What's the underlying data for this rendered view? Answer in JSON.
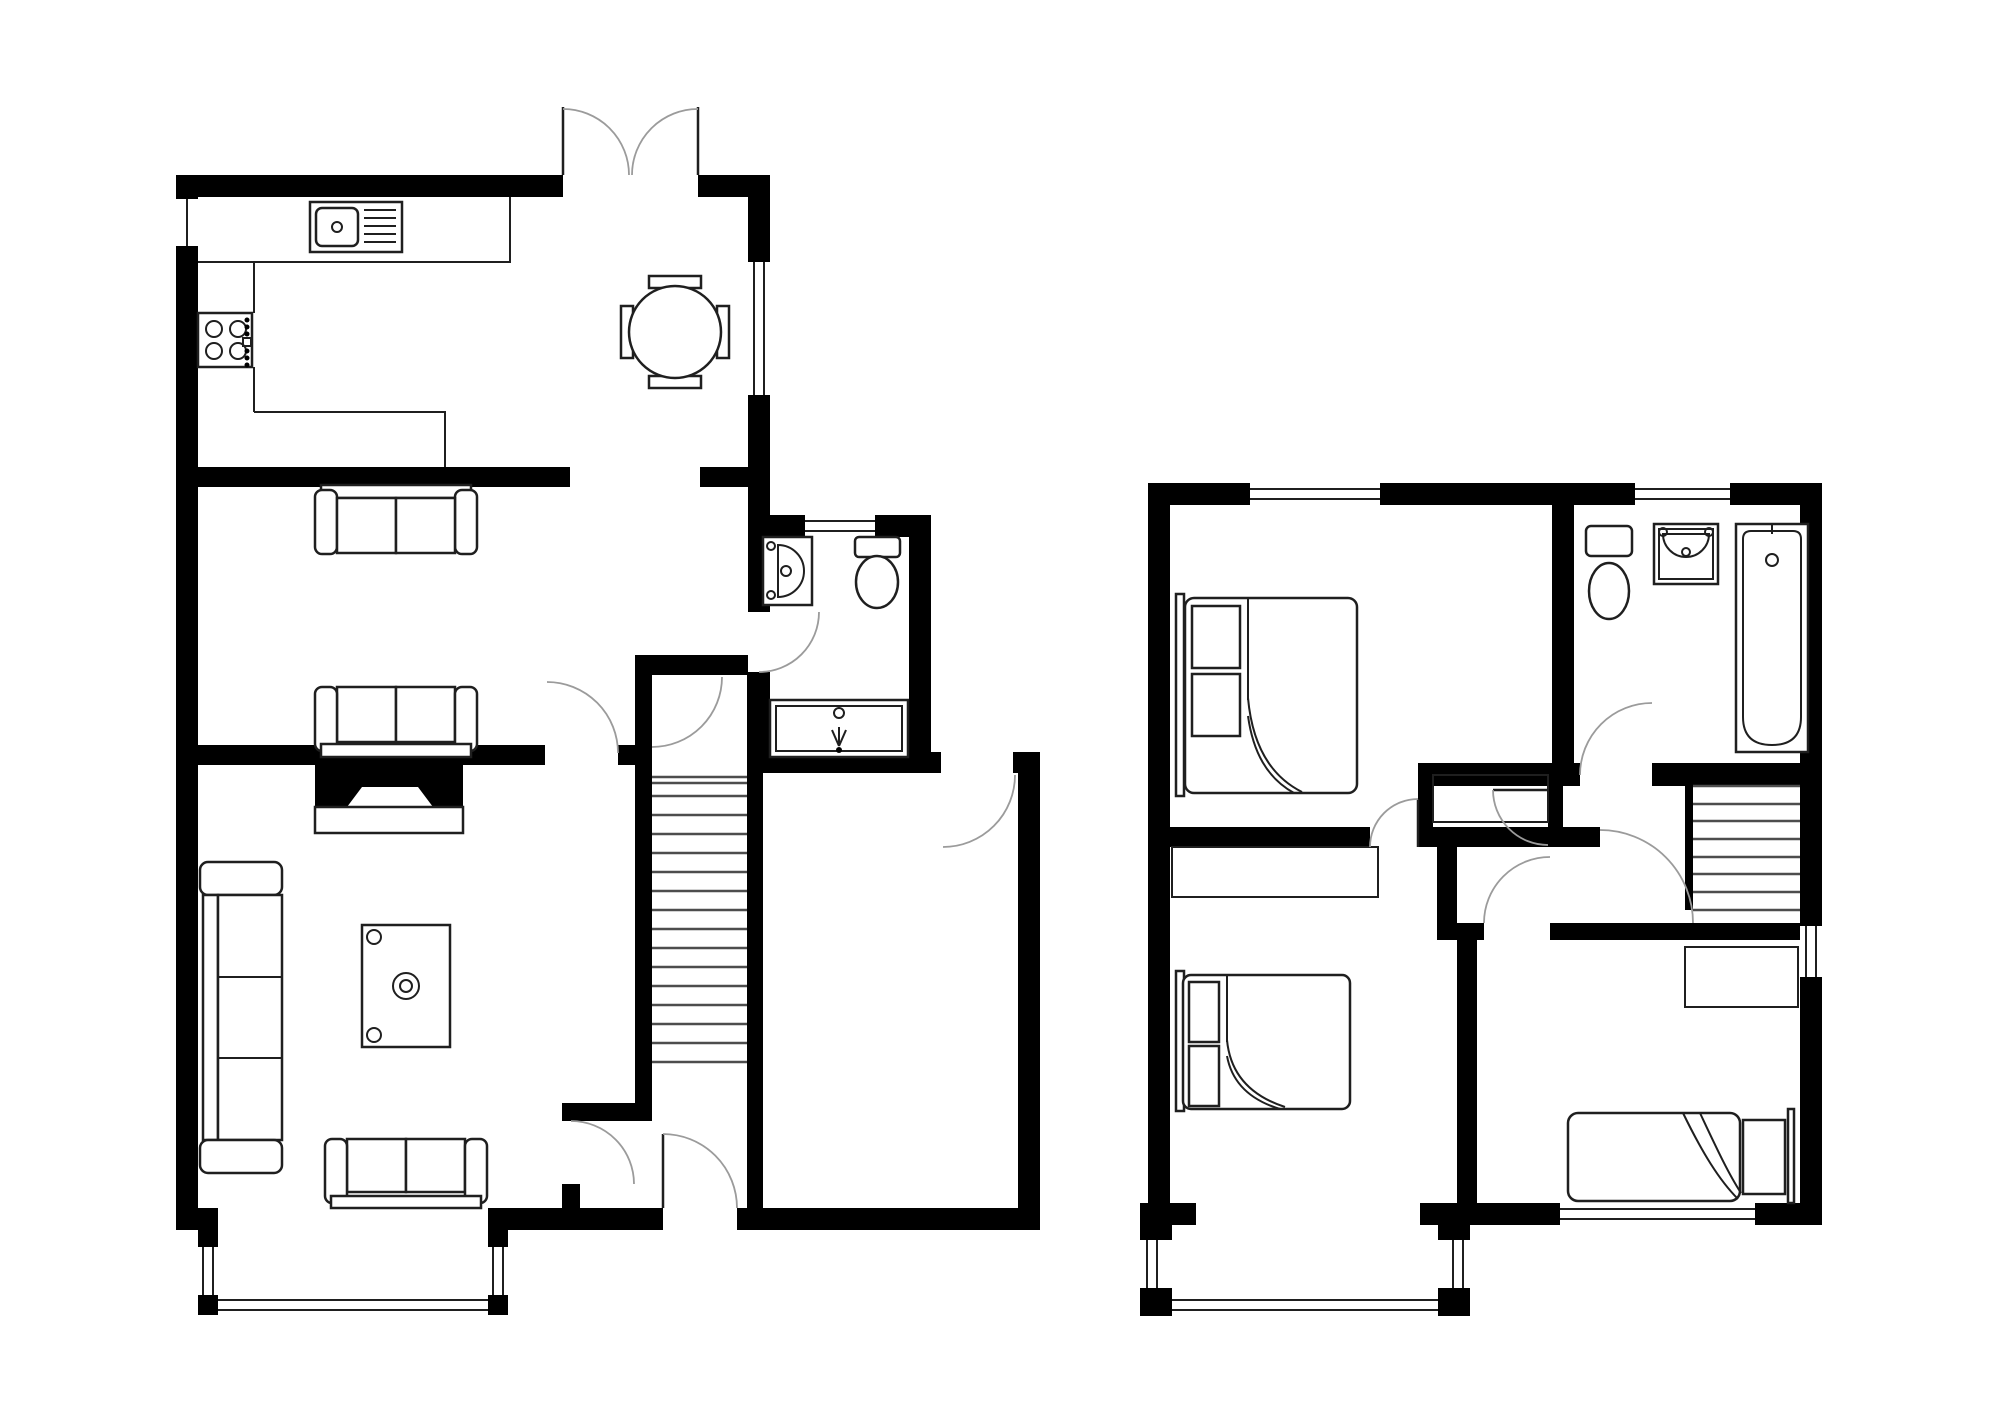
{
  "drawing": {
    "kind": "floor-plan",
    "visible_text": [],
    "floors": [
      {
        "id": "ground-floor",
        "position": "left",
        "rooms": [
          {
            "name": "kitchen-dining",
            "features": [
              "sink-with-drainer",
              "hob-4-burners",
              "l-shaped-worktop",
              "round-dining-table",
              "four-chairs",
              "double-french-doors",
              "side-window",
              "small-window"
            ]
          },
          {
            "name": "sitting-room",
            "features": [
              "two-seat-sofa",
              "two-seat-sofa",
              "fireplace-with-hearth",
              "door"
            ]
          },
          {
            "name": "living-room",
            "features": [
              "three-seat-corner-sofa",
              "coffee-table",
              "two-seat-sofa",
              "bay-window",
              "door"
            ]
          },
          {
            "name": "wc",
            "features": [
              "basin",
              "toilet",
              "shower-cubicle",
              "window",
              "door"
            ]
          },
          {
            "name": "hallway",
            "features": [
              "staircase-up",
              "front-door",
              "inner-doors"
            ]
          },
          {
            "name": "store-room",
            "features": [
              "door"
            ]
          }
        ]
      },
      {
        "id": "first-floor",
        "position": "right",
        "rooms": [
          {
            "name": "bedroom-1",
            "features": [
              "double-bed",
              "window",
              "door"
            ]
          },
          {
            "name": "bathroom",
            "features": [
              "toilet",
              "basin",
              "bath",
              "window",
              "door"
            ]
          },
          {
            "name": "landing",
            "features": [
              "staircase-down",
              "airing-cupboard",
              "side-window",
              "door-arcs"
            ]
          },
          {
            "name": "bedroom-2",
            "features": [
              "double-bed",
              "built-in-wardrobe",
              "bay-window",
              "door"
            ]
          },
          {
            "name": "bedroom-3",
            "features": [
              "single-bed",
              "desk",
              "window",
              "door"
            ]
          }
        ]
      }
    ],
    "colors": {
      "wall": "#000000",
      "background": "#ffffff",
      "furniture_line": "#1f1f1f",
      "door_arc": "#9b9b9b",
      "stair_line": "#4d4d4d"
    }
  }
}
